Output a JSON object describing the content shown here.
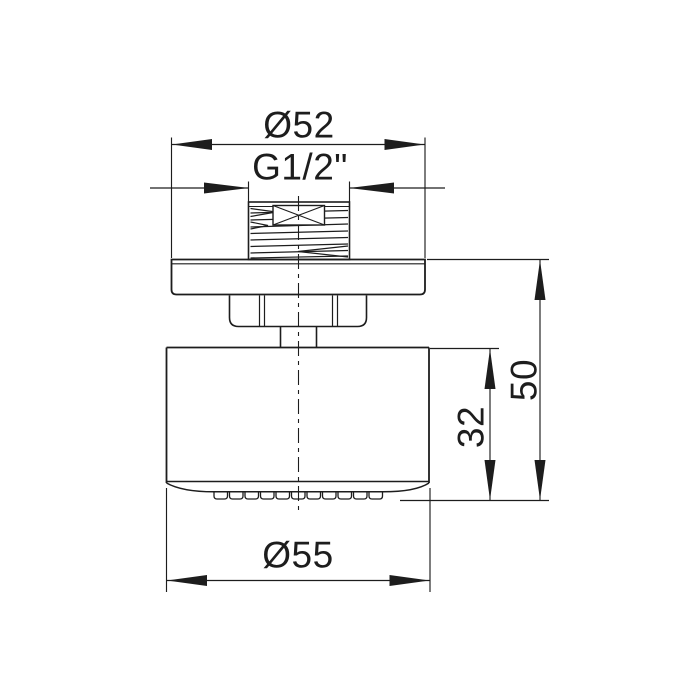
{
  "page": {
    "background_color": "#ffffff",
    "description": "Technical dimension drawing (front elevation) of an overhead shower head"
  },
  "drawing": {
    "part": "shower head",
    "view": "front elevation",
    "line_color": "#1d1d1d",
    "units": "mm"
  },
  "labels": {
    "flange_diameter": "Ø52",
    "thread_size": "G1/2\"",
    "overall_height": "50",
    "body_height": "32",
    "head_diameter": "Ø55"
  },
  "dimensions": [
    {
      "label": "Ø52",
      "value": 52,
      "unit": "mm",
      "orientation": "horizontal",
      "measures": "mounting flange diameter"
    },
    {
      "label": "G1/2\"",
      "value": "G1/2",
      "unit": "thread",
      "orientation": "horizontal",
      "measures": "connection thread size"
    },
    {
      "label": "50",
      "value": 50,
      "unit": "mm",
      "orientation": "vertical",
      "measures": "height from flange top to spray face"
    },
    {
      "label": "32",
      "value": 32,
      "unit": "mm",
      "orientation": "vertical",
      "measures": "body height to spray face"
    },
    {
      "label": "Ø55",
      "value": 55,
      "unit": "mm",
      "orientation": "horizontal",
      "measures": "shower head body diameter"
    }
  ]
}
